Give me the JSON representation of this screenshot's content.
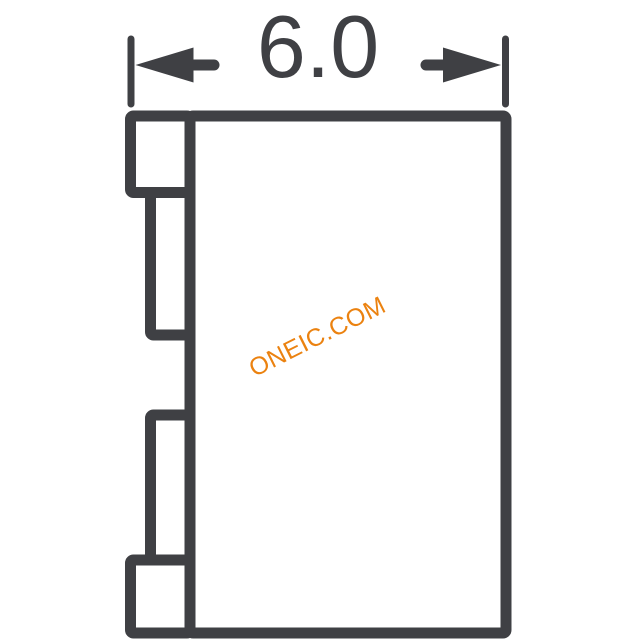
{
  "canvas": {
    "background": "#ffffff"
  },
  "diagram": {
    "kind": "component-package-outline-side-view",
    "dimension": {
      "label": "6.0"
    },
    "watermark": {
      "text": "ONEIC.COM"
    },
    "colors": {
      "outline": "#3F4044",
      "dimension_text": "#3F4044",
      "watermark": "#EB8210",
      "background": "#ffffff"
    }
  }
}
